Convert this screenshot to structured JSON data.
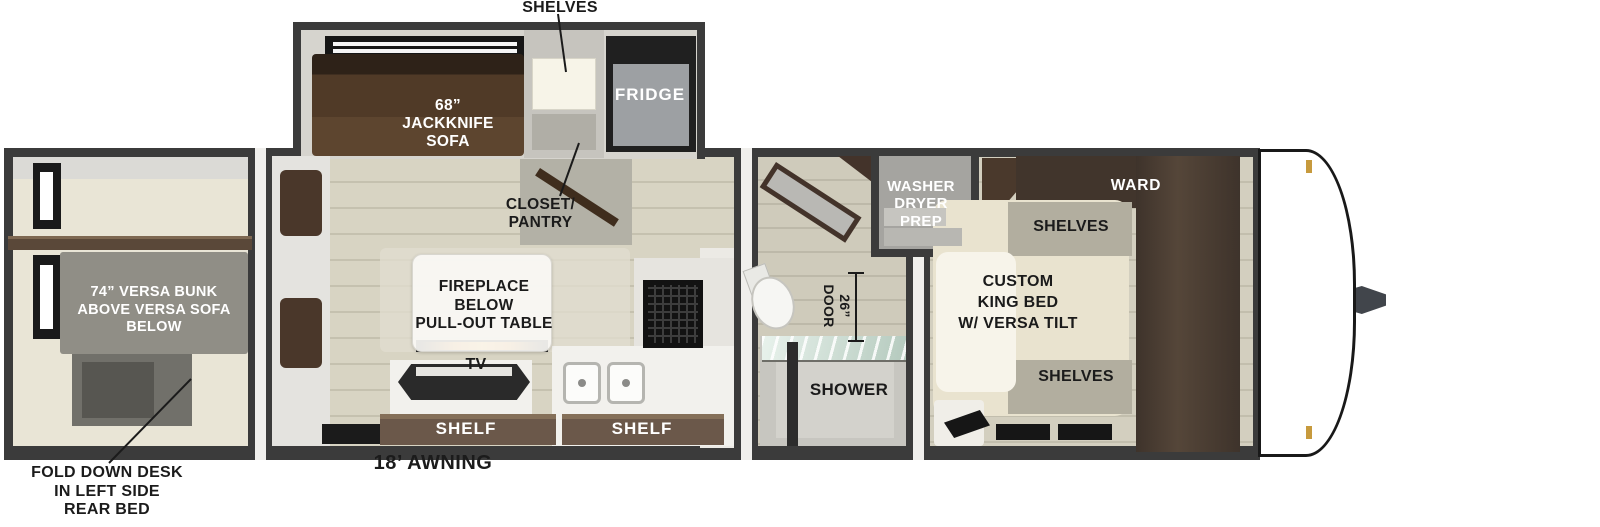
{
  "plan": {
    "labels": {
      "shelves_top": "SHELVES",
      "jackknife_sofa": "68”\nJACKKNIFE\nSOFA",
      "fridge": "FRIDGE",
      "closet_pantry": "CLOSET/\nPANTRY",
      "washer_dryer_prep": "WASHER\nDRYER\nPREP",
      "ward": "WARD",
      "shelves_bed_top": "SHELVES",
      "custom_king_bed": "CUSTOM\nKING BED\nW/ VERSA TILT",
      "shelves_bed_bottom": "SHELVES",
      "versa_bunk": "74” VERSA BUNK\nABOVE VERSA SOFA\nBELOW",
      "fireplace_table": "FIREPLACE\nBELOW\nPULL-OUT TABLE",
      "tv": "TV",
      "shelf_left": "SHELF",
      "shelf_right": "SHELF",
      "shower": "SHOWER",
      "door_26": "26”\nDOOR",
      "fold_down_desk": "FOLD DOWN DESK\nIN LEFT SIDE\nREAR BED",
      "awning": "18’ AWNING"
    },
    "colors": {
      "wall": "#3b3b3b",
      "floor_living": "#d8d4c3",
      "floor_rear_room": "#e9e5d6",
      "sofa_brown": "#503a27",
      "ward_brown": "#46382d",
      "shelf_board_brown": "#6b584a",
      "bed_cream": "#e9e3cf",
      "bunk_gray": "#908e86",
      "fridge_gray": "#9da0a3",
      "flame_orange": "#f4b24a",
      "front_cap": "#ffffff",
      "marker_light": "#c79a3d"
    }
  }
}
